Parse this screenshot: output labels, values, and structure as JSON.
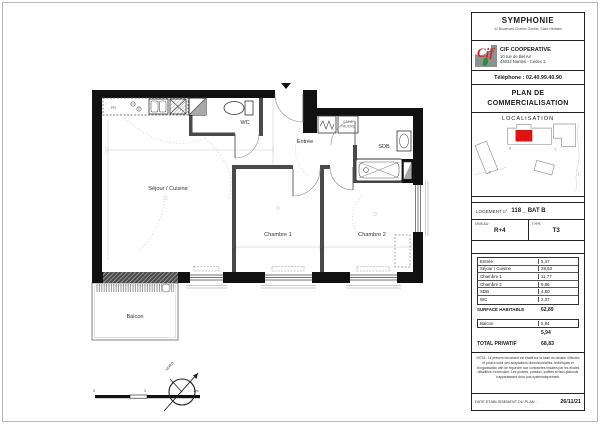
{
  "header": {
    "project": "SYMPHONIE",
    "project_address": "41 Boulevard Charles Gautier, Saint-Herblain",
    "company": "CIF COOPERATIVE",
    "company_address_1": "10 rue de Bel Air",
    "company_address_2": "44032 Nantes - Cedex 1",
    "phone": "Téléphone : 02.40.99.40.90"
  },
  "doc": {
    "title_line1": "PLAN DE",
    "title_line2": "COMMERCIALISATION",
    "localisation_title": "LOCALISATION"
  },
  "site_map": {
    "label_a": "A",
    "label_b": "B",
    "label_c": "C",
    "label_1": "1",
    "highlight_color": "#e01212"
  },
  "unit": {
    "logement_label": "LOGEMENT n°",
    "logement_value": "118 _ BAT B",
    "niveau_label": "NIVEAU :",
    "niveau_value": "R+4",
    "type_label": "TYPE :",
    "type_value": "T3"
  },
  "areas": {
    "rows": [
      {
        "label": "Entrée",
        "value": "5,47"
      },
      {
        "label": "Séjour / Cuisine",
        "value": "28,63"
      },
      {
        "label": "Chambre 1",
        "value": "11,77"
      },
      {
        "label": "Chambre 2",
        "value": "9,86"
      },
      {
        "label": "SDB",
        "value": "4,80"
      },
      {
        "label": "WC",
        "value": "2,37"
      }
    ],
    "surface_label": "SURFACE HABITABLE",
    "surface_value": "62,89",
    "balcon_label": "Balcon",
    "balcon_value": "5,94",
    "annex_total": "5,94",
    "total_label": "TOTAL PRIVATIF",
    "total_value": "68,83"
  },
  "nota": "NOTA : Le présent document est établi sur la base du dossier d'études et pourra subir des adaptations dimensionnelles, techniques et d'organisation afin de répondre aux contraintes induites par les études détaillées d'exécution. Les poutres, poteaux, soffites et faux-plafonds n'apparaissent donc pas systématiquement.",
  "date": {
    "label": "DATE ETABLISSEMENT DU PLAN :",
    "value": "26/11/21"
  },
  "plan": {
    "rooms": {
      "sejour": "Séjour / Cuisine",
      "wc": "WC",
      "entree": "Entrée",
      "sdb": "SDB",
      "chambre1": "Chambre 1",
      "chambre2": "Chambre 2",
      "balcon": "Balcon"
    },
    "fridge": "FR.",
    "closet_line1": "GAINE",
    "closet_line2": "PALIÈRE",
    "north": "NORD",
    "scale": {
      "s0": "0",
      "s1": "1",
      "s2": "2m"
    }
  }
}
